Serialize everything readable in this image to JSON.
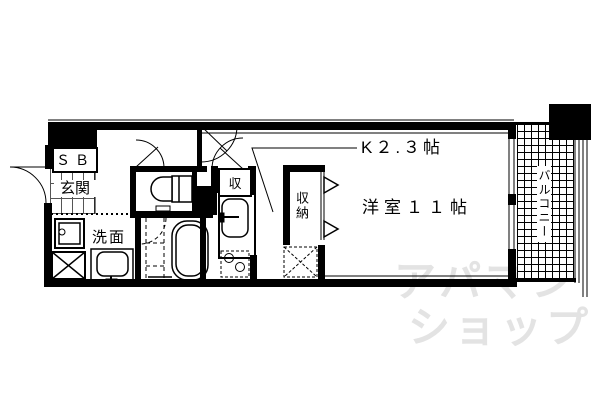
{
  "rooms": {
    "shoe_box": "ＳＢ",
    "entrance": "玄関",
    "washroom": "洗面",
    "storage_small": "収",
    "closet": "収納",
    "kitchen": "K２.３帖",
    "western_room": "洋室１１帖",
    "balcony": "バルコニー"
  },
  "watermark": {
    "line1": "アパマン",
    "line2": "ショップ"
  },
  "colors": {
    "line": "#000000",
    "background": "#ffffff",
    "watermark": "#e3e3e3"
  }
}
